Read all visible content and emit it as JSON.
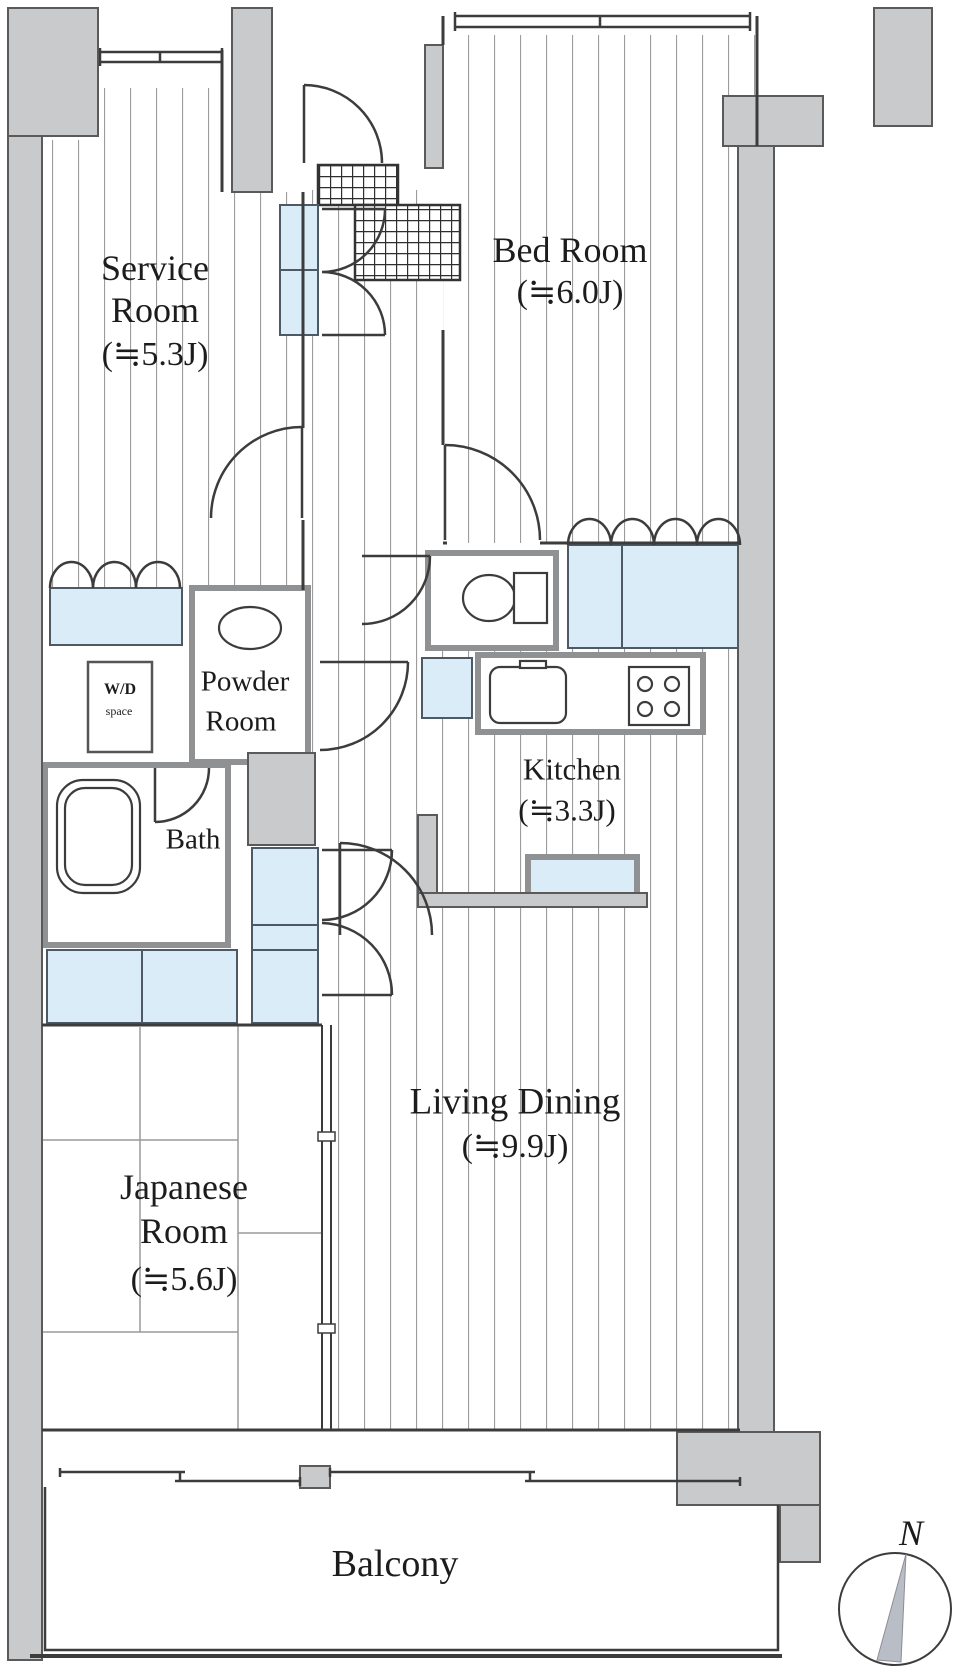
{
  "plan": {
    "rooms": {
      "service_room": {
        "line1": "Service",
        "line2": "Room",
        "size": "(≒5.3J)"
      },
      "bed_room": {
        "line1": "Bed Room",
        "size": "(≒6.0J)"
      },
      "powder_room": {
        "line1": "Powder",
        "line2": "Room"
      },
      "wd_space": {
        "line1": "W/D",
        "line2": "space"
      },
      "bath": {
        "line1": "Bath"
      },
      "kitchen": {
        "line1": "Kitchen",
        "size": "(≒3.3J)"
      },
      "japanese_room": {
        "line1": "Japanese",
        "line2": "Room",
        "size": "(≒5.6J)"
      },
      "living_dining": {
        "line1": "Living Dining",
        "size": "(≒9.9J)"
      },
      "balcony": {
        "line1": "Balcony"
      }
    },
    "compass": {
      "north_label": "N"
    },
    "colors": {
      "wall_fill": "#c9cacb",
      "wall_edge": "#5a5a5a",
      "closet_fill": "#daecf8",
      "closet_edge": "#4d5a66",
      "ink": "#3c3c3c",
      "needle_fill": "#b9bdc6"
    }
  }
}
